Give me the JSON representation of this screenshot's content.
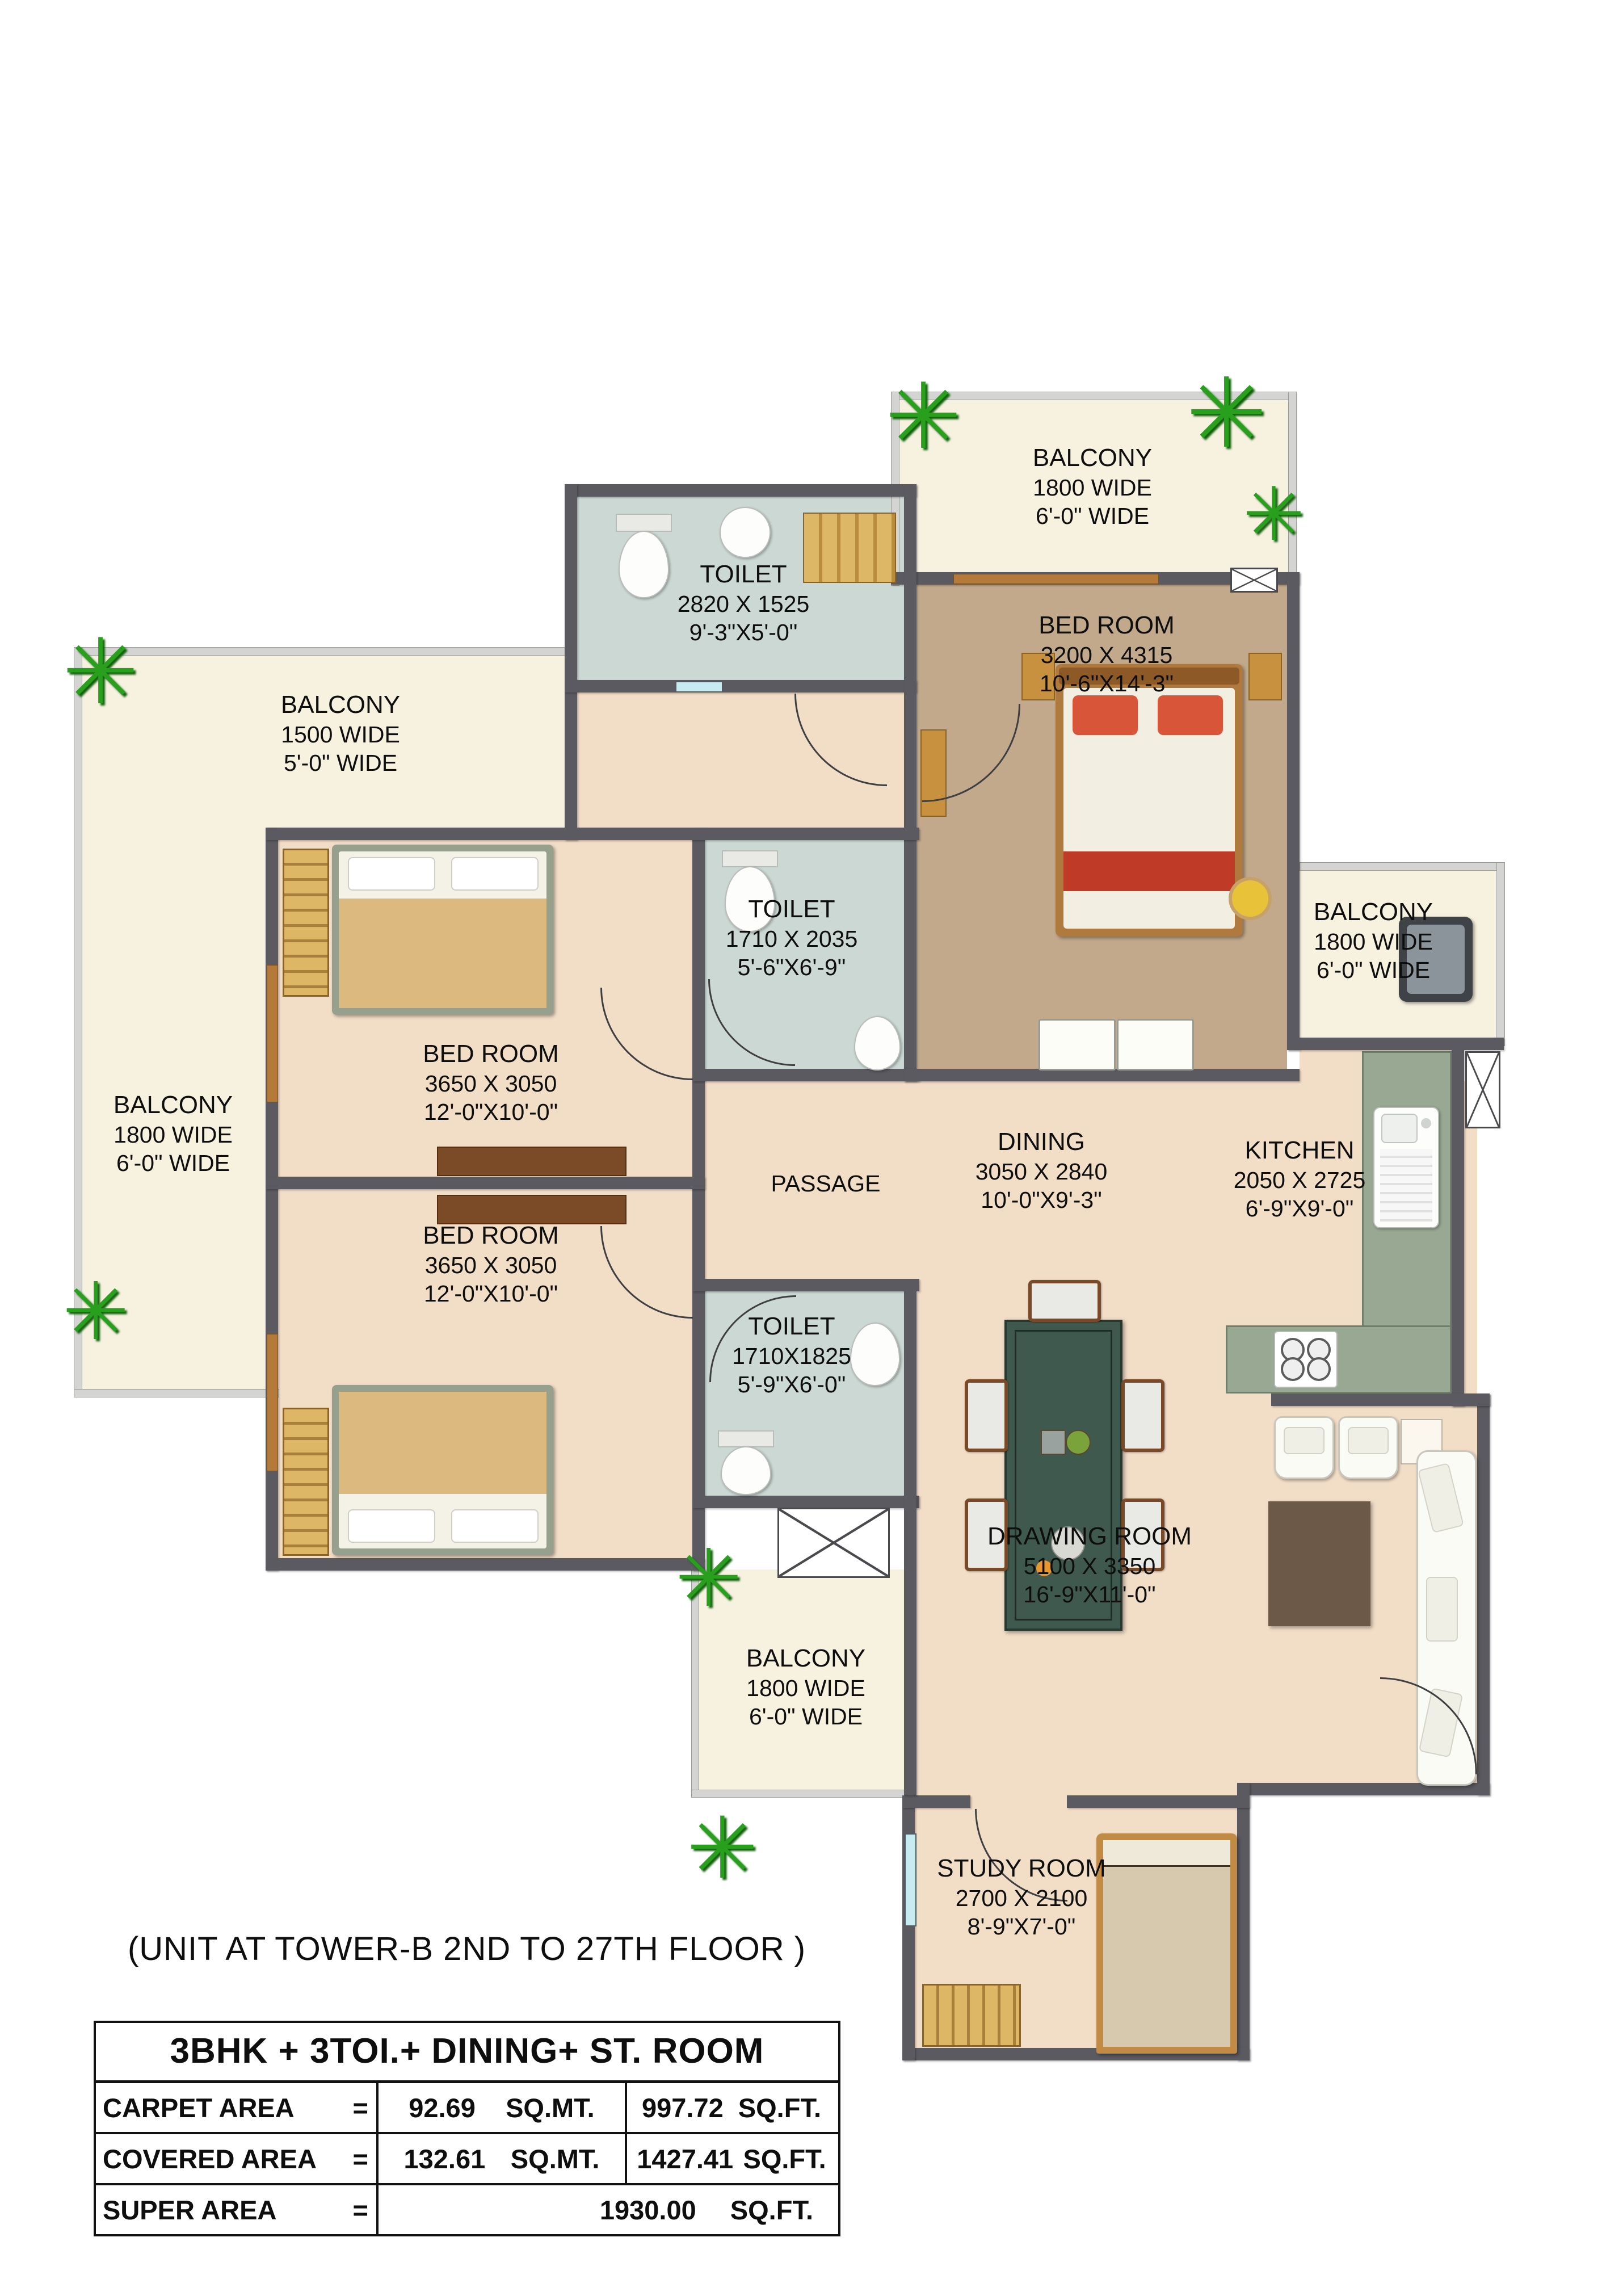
{
  "page_title": "(UNIT AT TOWER-B 2ND TO 27TH FLOOR )",
  "area_table": {
    "header": "3BHK + 3TOI.+ DINING+ ST. ROOM",
    "rows": [
      {
        "label": "CARPET AREA",
        "eq": "=",
        "mt": "92.69",
        "mt_unit": "SQ.MT.",
        "ft": "997.72",
        "ft_unit": "SQ.FT."
      },
      {
        "label": "COVERED AREA",
        "eq": "=",
        "mt": "132.61",
        "mt_unit": "SQ.MT.",
        "ft": "1427.41",
        "ft_unit": "SQ.FT."
      },
      {
        "label": "SUPER AREA",
        "eq": "=",
        "mt": "",
        "mt_unit": "",
        "ft": "1930.00",
        "ft_unit": "SQ.FT."
      }
    ]
  },
  "rooms": {
    "balcony_top": {
      "name": "BALCONY",
      "line2": "1800 WIDE",
      "line3": "6'-0\" WIDE"
    },
    "toilet_top": {
      "name": "TOILET",
      "line2": "2820 X 1525",
      "line3": "9'-3\"X5'-0\""
    },
    "bedroom_top": {
      "name": "BED ROOM",
      "line2": "3200 X 4315",
      "line3": "10'-6\"X14'-3\""
    },
    "balcony_top_left": {
      "name": "BALCONY",
      "line2": "1500 WIDE",
      "line3": "5'-0\" WIDE"
    },
    "balcony_left": {
      "name": "BALCONY",
      "line2": "1800 WIDE",
      "line3": "6'-0\" WIDE"
    },
    "bedroom_mid": {
      "name": "BED ROOM",
      "line2": "3650 X 3050",
      "line3": "12'-0\"X10'-0\""
    },
    "toilet_mid": {
      "name": "TOILET",
      "line2": "1710 X 2035",
      "line3": "5'-6\"X6'-9\""
    },
    "balcony_right": {
      "name": "BALCONY",
      "line2": "1800 WIDE",
      "line3": "6'-0\" WIDE"
    },
    "passage": {
      "name": "PASSAGE"
    },
    "dining": {
      "name": "DINING",
      "line2": "3050 X 2840",
      "line3": "10'-0\"X9'-3\""
    },
    "kitchen": {
      "name": "KITCHEN",
      "line2": "2050 X 2725",
      "line3": "6'-9\"X9'-0\""
    },
    "bedroom_lower": {
      "name": "BED ROOM",
      "line2": "3650 X 3050",
      "line3": "12'-0\"X10'-0\""
    },
    "toilet_lower": {
      "name": "TOILET",
      "line2": "1710X1825",
      "line3": "5'-9\"X6'-0\""
    },
    "drawing_room": {
      "name": "DRAWING ROOM",
      "line2": "5100 X 3350",
      "line3": "16'-9\"X11'-0\""
    },
    "balcony_bottom": {
      "name": "BALCONY",
      "line2": "1800 WIDE",
      "line3": "6'-0\" WIDE"
    },
    "study_room": {
      "name": "STUDY ROOM",
      "line2": "2700 X 2100",
      "line3": "8'-9\"X7'-0\""
    }
  },
  "icons": {
    "plant-icon": "✳"
  },
  "colors": {
    "wall": "#5a5a60",
    "balcony_floor": "#f7f1e0",
    "room_floor": "#f2ddc7",
    "master_floor": "#c2a98c",
    "toilet_floor": "#ccd8d4",
    "kitchen_counter": "#98a893",
    "dining_table": "#40594f",
    "rug": "#6c5947",
    "wood": "#b5793a",
    "bed_accent_red": "#c03a28",
    "plant_green": "#28a01e"
  }
}
